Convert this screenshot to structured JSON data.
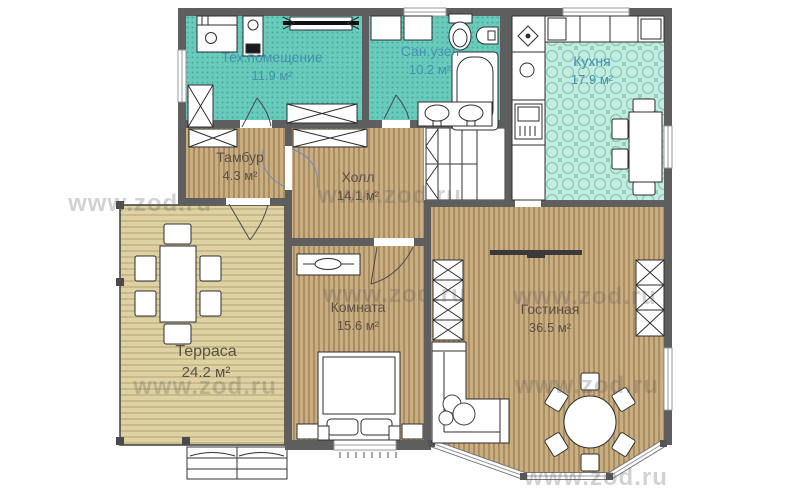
{
  "plan": {
    "watermark": "www.zod.ru",
    "colors": {
      "room_teal": "#68cbbc",
      "room_teal_dots": "#46ad9e",
      "kitchen_tile": "#c4ebdf",
      "wood_floor": "#c9ae82",
      "terrace_deck": "#ded2a2",
      "wall_gray": "#5e5e5e",
      "label_blue": "#4590b2",
      "label_brown": "#5b5147"
    },
    "rooms": [
      {
        "name": "Тех.помещение",
        "area": "11.9 м²"
      },
      {
        "name": "Сан.узел",
        "area": "10.2 м²"
      },
      {
        "name": "Кухня",
        "area": "17.9 м²"
      },
      {
        "name": "Тамбур",
        "area": "4.3 м²"
      },
      {
        "name": "Холл",
        "area": "14.1 м²"
      },
      {
        "name": "Комната",
        "area": "15.6 м²"
      },
      {
        "name": "Гостиная",
        "area": "36.5 м²"
      },
      {
        "name": "Терраса",
        "area": "24.2 м²"
      }
    ]
  }
}
